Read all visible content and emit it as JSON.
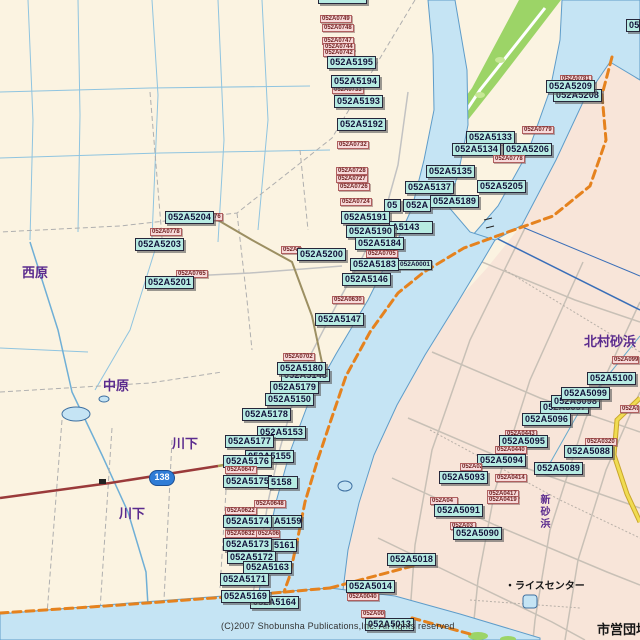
{
  "map": {
    "attribution": "(C)2007 Shobunsha Publications,Inc. All rights reserved",
    "route_shield": {
      "number": "138"
    },
    "place_names": [
      {
        "text": "西原",
        "x": 22,
        "y": 262,
        "cls": "purple"
      },
      {
        "text": "中原",
        "x": 103,
        "y": 375,
        "cls": "purple"
      },
      {
        "text": "川下",
        "x": 172,
        "y": 433,
        "cls": "purple"
      },
      {
        "text": "川下",
        "x": 119,
        "y": 503,
        "cls": "purple"
      },
      {
        "text": "北村砂浜",
        "x": 584,
        "y": 331,
        "cls": "purple"
      },
      {
        "text": "新砂浜",
        "x": 536,
        "y": 494,
        "cls": "vert"
      },
      {
        "text": "市営団地",
        "x": 597,
        "y": 619,
        "cls": "black"
      },
      {
        "text": "・ライスセンター",
        "x": 505,
        "y": 577,
        "cls": "small-black"
      }
    ],
    "labels": [
      {
        "t": "052A5196",
        "x": 318,
        "y": -9,
        "k": "c"
      },
      {
        "t": "052A0749",
        "x": 320,
        "y": 15,
        "k": "p"
      },
      {
        "t": "052A0748",
        "x": 322,
        "y": 24,
        "k": "p"
      },
      {
        "t": "052A0747",
        "x": 322,
        "y": 37,
        "k": "p"
      },
      {
        "t": "052A0744",
        "x": 323,
        "y": 43,
        "k": "p"
      },
      {
        "t": "052A0742",
        "x": 323,
        "y": 49,
        "k": "p"
      },
      {
        "t": "052A5195",
        "x": 327,
        "y": 56,
        "k": "c"
      },
      {
        "t": "052A0733",
        "x": 332,
        "y": 86,
        "k": "p"
      },
      {
        "t": "052A5194",
        "x": 331,
        "y": 75,
        "k": "c"
      },
      {
        "t": "052A5193",
        "x": 334,
        "y": 95,
        "k": "c"
      },
      {
        "t": "052A5192",
        "x": 337,
        "y": 118,
        "k": "c"
      },
      {
        "t": "052A0732",
        "x": 337,
        "y": 141,
        "k": "p"
      },
      {
        "t": "052A0728",
        "x": 336,
        "y": 167,
        "k": "p"
      },
      {
        "t": "052A0727",
        "x": 336,
        "y": 175,
        "k": "p"
      },
      {
        "t": "052A0726",
        "x": 338,
        "y": 183,
        "k": "p"
      },
      {
        "t": "052A0724",
        "x": 340,
        "y": 198,
        "k": "p"
      },
      {
        "t": "052A0781",
        "x": 560,
        "y": 75,
        "k": "p"
      },
      {
        "t": "052A5208",
        "x": 553,
        "y": 89,
        "k": "c"
      },
      {
        "t": "052A5209",
        "x": 546,
        "y": 80,
        "k": "c"
      },
      {
        "t": "052",
        "x": 626,
        "y": 19,
        "k": "c",
        "w": 14
      },
      {
        "t": "052A0779",
        "x": 522,
        "y": 126,
        "k": "p"
      },
      {
        "t": "052A5133",
        "x": 466,
        "y": 131,
        "k": "c"
      },
      {
        "t": "052A5134",
        "x": 452,
        "y": 143,
        "k": "c"
      },
      {
        "t": "052A5206",
        "x": 503,
        "y": 143,
        "k": "c"
      },
      {
        "t": "052A0778",
        "x": 493,
        "y": 155,
        "k": "p"
      },
      {
        "t": "052A5135",
        "x": 426,
        "y": 165,
        "k": "c"
      },
      {
        "t": "052A5137",
        "x": 405,
        "y": 181,
        "k": "c"
      },
      {
        "t": "052A5205",
        "x": 477,
        "y": 180,
        "k": "c"
      },
      {
        "t": "05",
        "x": 384,
        "y": 199,
        "k": "c",
        "w": 17
      },
      {
        "t": "052A",
        "x": 403,
        "y": 199,
        "k": "c",
        "w": 28
      },
      {
        "t": "052A5189",
        "x": 430,
        "y": 195,
        "k": "c"
      },
      {
        "t": "052A0776",
        "x": 191,
        "y": 213,
        "k": "p"
      },
      {
        "t": "052A5204",
        "x": 165,
        "y": 211,
        "k": "c"
      },
      {
        "t": "052A0778",
        "x": 150,
        "y": 228,
        "k": "p"
      },
      {
        "t": "052A5203",
        "x": 135,
        "y": 238,
        "k": "c"
      },
      {
        "t": "052A0765",
        "x": 176,
        "y": 270,
        "k": "p"
      },
      {
        "t": "052A5201",
        "x": 145,
        "y": 276,
        "k": "c"
      },
      {
        "t": "052A07",
        "x": 281,
        "y": 246,
        "k": "p",
        "w": 20
      },
      {
        "t": "052A5200",
        "x": 297,
        "y": 248,
        "k": "c"
      },
      {
        "t": "052A5191",
        "x": 341,
        "y": 211,
        "k": "c"
      },
      {
        "t": "A5143",
        "x": 389,
        "y": 221,
        "k": "c",
        "w": 44
      },
      {
        "t": "052A5190",
        "x": 346,
        "y": 225,
        "k": "c"
      },
      {
        "t": "052A5184",
        "x": 355,
        "y": 237,
        "k": "c"
      },
      {
        "t": "052A0705",
        "x": 366,
        "y": 250,
        "k": "p"
      },
      {
        "t": "052A5183",
        "x": 350,
        "y": 258,
        "k": "c"
      },
      {
        "t": "052A0001",
        "x": 398,
        "y": 260,
        "k": "s"
      },
      {
        "t": "052A5146",
        "x": 342,
        "y": 273,
        "k": "c"
      },
      {
        "t": "052A0630",
        "x": 332,
        "y": 296,
        "k": "p"
      },
      {
        "t": "052A5147",
        "x": 315,
        "y": 313,
        "k": "c"
      },
      {
        "t": "052A0702",
        "x": 283,
        "y": 353,
        "k": "p"
      },
      {
        "t": "052A5148",
        "x": 281,
        "y": 369,
        "k": "c"
      },
      {
        "t": "052A5180",
        "x": 277,
        "y": 362,
        "k": "c"
      },
      {
        "t": "052A5179",
        "x": 270,
        "y": 381,
        "k": "c"
      },
      {
        "t": "052A5150",
        "x": 265,
        "y": 393,
        "k": "c"
      },
      {
        "t": "052A5178",
        "x": 242,
        "y": 408,
        "k": "c"
      },
      {
        "t": "052A5153",
        "x": 257,
        "y": 426,
        "k": "c"
      },
      {
        "t": "052A5177",
        "x": 225,
        "y": 435,
        "k": "c"
      },
      {
        "t": "052A5155",
        "x": 245,
        "y": 450,
        "k": "c"
      },
      {
        "t": "052A5176",
        "x": 223,
        "y": 455,
        "k": "c"
      },
      {
        "t": "052A0647",
        "x": 225,
        "y": 466,
        "k": "p"
      },
      {
        "t": "052A5175",
        "x": 223,
        "y": 475,
        "k": "c"
      },
      {
        "t": "5158",
        "x": 268,
        "y": 476,
        "k": "c",
        "w": 30
      },
      {
        "t": "052A0648",
        "x": 254,
        "y": 500,
        "k": "p"
      },
      {
        "t": "052A0622",
        "x": 225,
        "y": 507,
        "k": "p"
      },
      {
        "t": "A5159",
        "x": 271,
        "y": 515,
        "k": "c",
        "w": 31
      },
      {
        "t": "052A5174",
        "x": 223,
        "y": 515,
        "k": "c"
      },
      {
        "t": "052A0632",
        "x": 225,
        "y": 530,
        "k": "p"
      },
      {
        "t": "052A06",
        "x": 256,
        "y": 530,
        "k": "p",
        "w": 24
      },
      {
        "t": "5161",
        "x": 271,
        "y": 539,
        "k": "c",
        "w": 26
      },
      {
        "t": "052A5173",
        "x": 223,
        "y": 538,
        "k": "c"
      },
      {
        "t": "052A5172",
        "x": 227,
        "y": 551,
        "k": "c"
      },
      {
        "t": "052A5163",
        "x": 243,
        "y": 561,
        "k": "c"
      },
      {
        "t": "052A5171",
        "x": 220,
        "y": 573,
        "k": "c"
      },
      {
        "t": "052A5164",
        "x": 250,
        "y": 596,
        "k": "c"
      },
      {
        "t": "052A5169",
        "x": 221,
        "y": 590,
        "k": "c"
      },
      {
        "t": "052A5018",
        "x": 387,
        "y": 553,
        "k": "c"
      },
      {
        "t": "052A5014",
        "x": 346,
        "y": 580,
        "k": "c"
      },
      {
        "t": "052A0040",
        "x": 347,
        "y": 593,
        "k": "p"
      },
      {
        "t": "052A00",
        "x": 361,
        "y": 610,
        "k": "p",
        "w": 24
      },
      {
        "t": "052A5013",
        "x": 365,
        "y": 618,
        "k": "c"
      },
      {
        "t": "052A0999",
        "x": 612,
        "y": 356,
        "k": "p",
        "w": 27
      },
      {
        "t": "052A5097",
        "x": 540,
        "y": 401,
        "k": "c"
      },
      {
        "t": "052A5098",
        "x": 551,
        "y": 395,
        "k": "c"
      },
      {
        "t": "052A5099",
        "x": 561,
        "y": 387,
        "k": "c"
      },
      {
        "t": "052A5100",
        "x": 587,
        "y": 372,
        "k": "c"
      },
      {
        "t": "052A0",
        "x": 620,
        "y": 405,
        "k": "p",
        "w": 19
      },
      {
        "t": "052A5096",
        "x": 522,
        "y": 413,
        "k": "c"
      },
      {
        "t": "052A0320",
        "x": 585,
        "y": 438,
        "k": "p"
      },
      {
        "t": "052A5088",
        "x": 564,
        "y": 445,
        "k": "c"
      },
      {
        "t": "052A5089",
        "x": 534,
        "y": 462,
        "k": "c"
      },
      {
        "t": "052A0443",
        "x": 505,
        "y": 430,
        "k": "p"
      },
      {
        "t": "052A5095",
        "x": 499,
        "y": 435,
        "k": "c"
      },
      {
        "t": "052A0440",
        "x": 495,
        "y": 446,
        "k": "p"
      },
      {
        "t": "052A5094",
        "x": 477,
        "y": 454,
        "k": "c"
      },
      {
        "t": "052A02",
        "x": 460,
        "y": 463,
        "k": "p",
        "w": 22
      },
      {
        "t": "052A0414",
        "x": 495,
        "y": 474,
        "k": "p"
      },
      {
        "t": "052A5093",
        "x": 439,
        "y": 471,
        "k": "c"
      },
      {
        "t": "052A0417",
        "x": 487,
        "y": 490,
        "k": "p"
      },
      {
        "t": "052A0419",
        "x": 487,
        "y": 496,
        "k": "p"
      },
      {
        "t": "052A04",
        "x": 430,
        "y": 497,
        "k": "p",
        "w": 28
      },
      {
        "t": "052A5091",
        "x": 434,
        "y": 504,
        "k": "c"
      },
      {
        "t": "052A03",
        "x": 450,
        "y": 522,
        "k": "p",
        "w": 26
      },
      {
        "t": "052A5090",
        "x": 453,
        "y": 527,
        "k": "c"
      }
    ]
  }
}
